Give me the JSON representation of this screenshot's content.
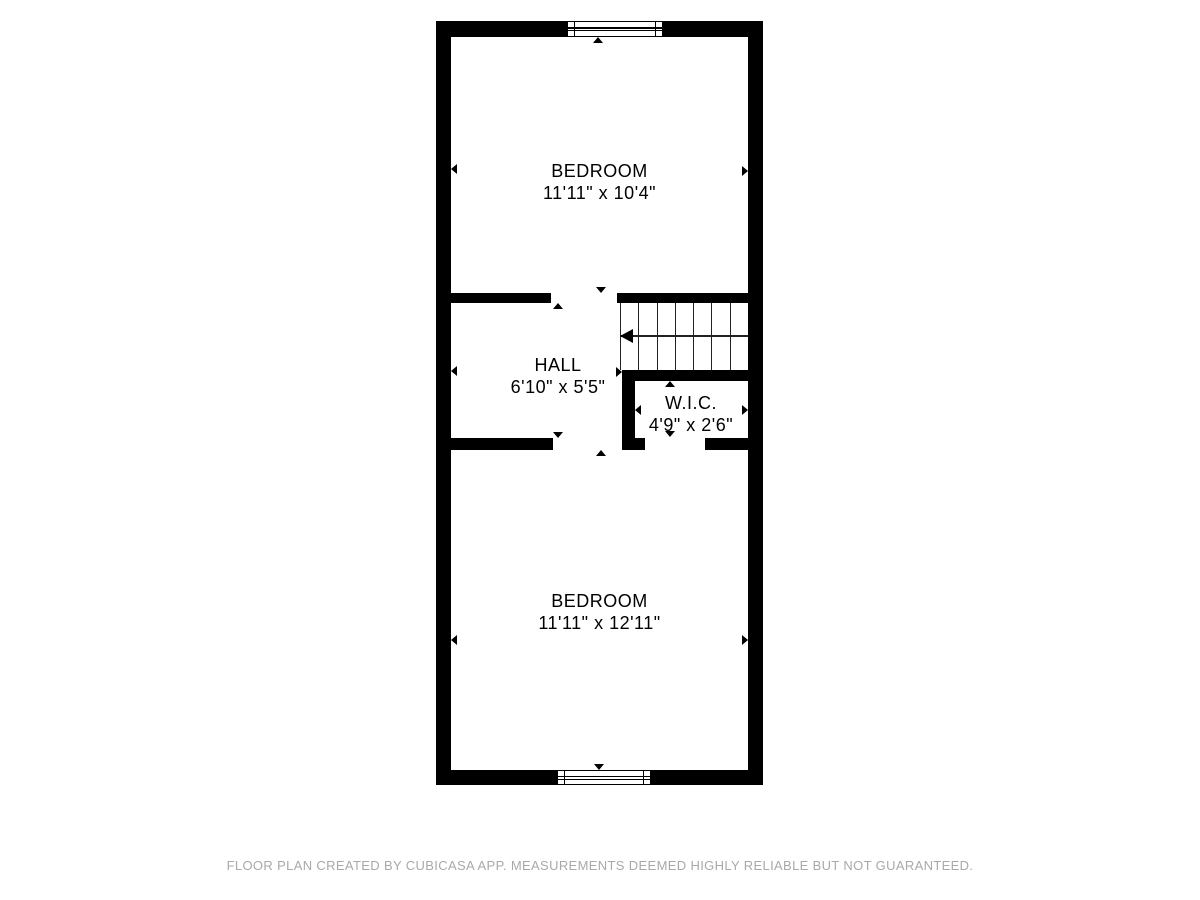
{
  "colors": {
    "wall": "#000000",
    "background": "#ffffff",
    "footer_text": "#a9a9a9",
    "stair_lines": "#222222"
  },
  "rooms": {
    "bedroom_top": {
      "name": "BEDROOM",
      "dims": "11'11\" x 10'4\""
    },
    "hall": {
      "name": "HALL",
      "dims": "6'10\" x 5'5\""
    },
    "wic": {
      "name": "W.I.C.",
      "dims": "4'9\" x 2'6\""
    },
    "bedroom_bottom": {
      "name": "BEDROOM",
      "dims": "11'11\" x 12'11\""
    }
  },
  "stairs": {
    "treads": 7,
    "direction": "left"
  },
  "footer": {
    "text": "FLOOR PLAN CREATED BY CUBICASA APP. MEASUREMENTS DEEMED HIGHLY RELIABLE BUT NOT GUARANTEED."
  }
}
